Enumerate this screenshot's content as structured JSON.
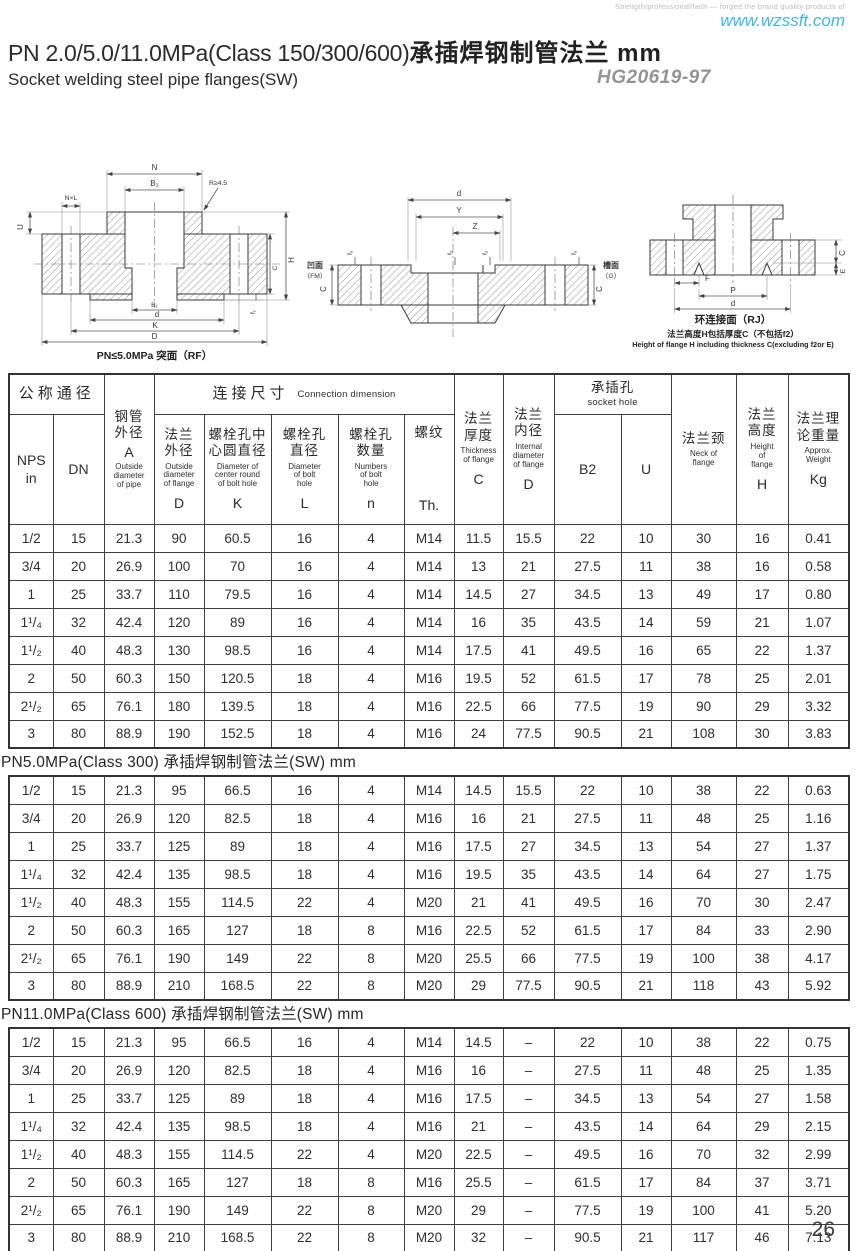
{
  "page": {
    "tagline": "Strength/professional/faith — forged the brand quality products of",
    "website": "www.wzssft.com",
    "title_en": "PN 2.0/5.0/11.0MPa(Class 150/300/600)",
    "title_cn": "承插焊钢制管法兰 mm",
    "subtitle": "Socket welding steel pipe flanges(SW)",
    "standard": "HG20619-97",
    "page_number": "26"
  },
  "drawings": {
    "left": {
      "caption": "PN≤5.0MPa 突面（RF）",
      "dims": {
        "n": "N",
        "b2": "B₂",
        "nl": "N×L",
        "r": "R≥4.5",
        "u": "U",
        "h": "H",
        "c": "C",
        "f1": "f₁",
        "b1": "B₁",
        "d": "d",
        "k": "K",
        "dd": "D"
      }
    },
    "middle": {
      "face_left_cn": "凹面",
      "face_left_en": "（FM）",
      "face_right_cn": "槽面",
      "face_right_en": "（G）",
      "dims": {
        "d": "d",
        "y": "Y",
        "z": "Z",
        "f2": "f₂",
        "c": "C"
      }
    },
    "right": {
      "caption": "环连接面（RJ）",
      "note_cn": "法兰高度H包括厚度C（不包括f2）",
      "note_en": "Height of flange H including thickness C(excluding f2or E)",
      "dims": {
        "c": "C",
        "e": "E",
        "f": "F",
        "p": "P",
        "d": "d"
      }
    }
  },
  "table": {
    "column_keys": [
      "nps",
      "dn",
      "a",
      "d",
      "k",
      "l",
      "n",
      "th",
      "c",
      "di",
      "b2",
      "u",
      "neck",
      "h",
      "kg"
    ],
    "header": {
      "nominal": "公称通径",
      "nps": "NPS\nin",
      "dn": "DN",
      "pipe": {
        "cn": "钢管\n外径",
        "sym": "A",
        "en": "Outside\ndiameter\nof pipe"
      },
      "connection": {
        "cn": "连接尺寸",
        "en": "Connection dimension"
      },
      "cols": [
        {
          "cn": "法兰\n外径",
          "en": "Outside\ndiameter\nof flange",
          "sym": "D"
        },
        {
          "cn": "螺栓孔中\n心圆直径",
          "en": "Diameter of\ncenter round\nof bolt hole",
          "sym": "K"
        },
        {
          "cn": "螺栓孔\n直径",
          "en": "Diameter\nof bolt\nhole",
          "sym": "L"
        },
        {
          "cn": "螺栓孔\n数量",
          "en": "Numbers\nof bolt\nhole",
          "sym": "n"
        },
        {
          "cn": "螺纹",
          "en": "",
          "sym": "Th."
        }
      ],
      "thickness": {
        "cn": "法兰\n厚度",
        "en": "Thickness\nof flange",
        "sym": "C"
      },
      "internal": {
        "cn": "法兰\n内径",
        "en": "Internal\ndiameter\nof flange",
        "sym": "D"
      },
      "socket": {
        "cn": "承插孔",
        "en": "socket hole"
      },
      "b2": "B2",
      "u": "U",
      "neck": {
        "cn": "法兰颈",
        "en": "Neck of\nflange"
      },
      "height": {
        "cn": "法兰\n高度",
        "en": "Height\nof\nflange",
        "sym": "H"
      },
      "weight": {
        "cn": "法兰理\n论重量",
        "en": "Approx.\nWeight",
        "sym": "Kg"
      }
    },
    "sections": [
      {
        "title": "",
        "rows": [
          [
            "1/2",
            "15",
            "21.3",
            "90",
            "60.5",
            "16",
            "4",
            "M14",
            "11.5",
            "15.5",
            "22",
            "10",
            "30",
            "16",
            "0.41"
          ],
          [
            "3/4",
            "20",
            "26.9",
            "100",
            "70",
            "16",
            "4",
            "M14",
            "13",
            "21",
            "27.5",
            "11",
            "38",
            "16",
            "0.58"
          ],
          [
            "1",
            "25",
            "33.7",
            "110",
            "79.5",
            "16",
            "4",
            "M14",
            "14.5",
            "27",
            "34.5",
            "13",
            "49",
            "17",
            "0.80"
          ],
          [
            "1¹/₄",
            "32",
            "42.4",
            "120",
            "89",
            "16",
            "4",
            "M14",
            "16",
            "35",
            "43.5",
            "14",
            "59",
            "21",
            "1.07"
          ],
          [
            "1¹/₂",
            "40",
            "48.3",
            "130",
            "98.5",
            "16",
            "4",
            "M14",
            "17.5",
            "41",
            "49.5",
            "16",
            "65",
            "22",
            "1.37"
          ],
          [
            "2",
            "50",
            "60.3",
            "150",
            "120.5",
            "18",
            "4",
            "M16",
            "19.5",
            "52",
            "61.5",
            "17",
            "78",
            "25",
            "2.01"
          ],
          [
            "2¹/₂",
            "65",
            "76.1",
            "180",
            "139.5",
            "18",
            "4",
            "M16",
            "22.5",
            "66",
            "77.5",
            "19",
            "90",
            "29",
            "3.32"
          ],
          [
            "3",
            "80",
            "88.9",
            "190",
            "152.5",
            "18",
            "4",
            "M16",
            "24",
            "77.5",
            "90.5",
            "21",
            "108",
            "30",
            "3.83"
          ]
        ]
      },
      {
        "title": "PN5.0MPa(Class 300) 承插焊钢制管法兰(SW)  mm",
        "rows": [
          [
            "1/2",
            "15",
            "21.3",
            "95",
            "66.5",
            "16",
            "4",
            "M14",
            "14.5",
            "15.5",
            "22",
            "10",
            "38",
            "22",
            "0.63"
          ],
          [
            "3/4",
            "20",
            "26.9",
            "120",
            "82.5",
            "18",
            "4",
            "M16",
            "16",
            "21",
            "27.5",
            "11",
            "48",
            "25",
            "1.16"
          ],
          [
            "1",
            "25",
            "33.7",
            "125",
            "89",
            "18",
            "4",
            "M16",
            "17.5",
            "27",
            "34.5",
            "13",
            "54",
            "27",
            "1.37"
          ],
          [
            "1¹/₄",
            "32",
            "42.4",
            "135",
            "98.5",
            "18",
            "4",
            "M16",
            "19.5",
            "35",
            "43.5",
            "14",
            "64",
            "27",
            "1.75"
          ],
          [
            "1¹/₂",
            "40",
            "48.3",
            "155",
            "114.5",
            "22",
            "4",
            "M20",
            "21",
            "41",
            "49.5",
            "16",
            "70",
            "30",
            "2.47"
          ],
          [
            "2",
            "50",
            "60.3",
            "165",
            "127",
            "18",
            "8",
            "M16",
            "22.5",
            "52",
            "61.5",
            "17",
            "84",
            "33",
            "2.90"
          ],
          [
            "2¹/₂",
            "65",
            "76.1",
            "190",
            "149",
            "22",
            "8",
            "M20",
            "25.5",
            "66",
            "77.5",
            "19",
            "100",
            "38",
            "4.17"
          ],
          [
            "3",
            "80",
            "88.9",
            "210",
            "168.5",
            "22",
            "8",
            "M20",
            "29",
            "77.5",
            "90.5",
            "21",
            "118",
            "43",
            "5.92"
          ]
        ]
      },
      {
        "title": "PN11.0MPa(Class 600) 承插焊钢制管法兰(SW)  mm",
        "rows": [
          [
            "1/2",
            "15",
            "21.3",
            "95",
            "66.5",
            "16",
            "4",
            "M14",
            "14.5",
            "–",
            "22",
            "10",
            "38",
            "22",
            "0.75"
          ],
          [
            "3/4",
            "20",
            "26.9",
            "120",
            "82.5",
            "18",
            "4",
            "M16",
            "16",
            "–",
            "27.5",
            "11",
            "48",
            "25",
            "1.35"
          ],
          [
            "1",
            "25",
            "33.7",
            "125",
            "89",
            "18",
            "4",
            "M16",
            "17.5",
            "–",
            "34.5",
            "13",
            "54",
            "27",
            "1.58"
          ],
          [
            "1¹/₄",
            "32",
            "42.4",
            "135",
            "98.5",
            "18",
            "4",
            "M16",
            "21",
            "–",
            "43.5",
            "14",
            "64",
            "29",
            "2.15"
          ],
          [
            "1¹/₂",
            "40",
            "48.3",
            "155",
            "114.5",
            "22",
            "4",
            "M20",
            "22.5",
            "–",
            "49.5",
            "16",
            "70",
            "32",
            "2.99"
          ],
          [
            "2",
            "50",
            "60.3",
            "165",
            "127",
            "18",
            "8",
            "M16",
            "25.5",
            "–",
            "61.5",
            "17",
            "84",
            "37",
            "3.71"
          ],
          [
            "2¹/₂",
            "65",
            "76.1",
            "190",
            "149",
            "22",
            "8",
            "M20",
            "29",
            "–",
            "77.5",
            "19",
            "100",
            "41",
            "5.20"
          ],
          [
            "3",
            "80",
            "88.9",
            "210",
            "168.5",
            "22",
            "8",
            "M20",
            "32",
            "–",
            "90.5",
            "21",
            "117",
            "46",
            "7.13"
          ]
        ]
      }
    ]
  }
}
